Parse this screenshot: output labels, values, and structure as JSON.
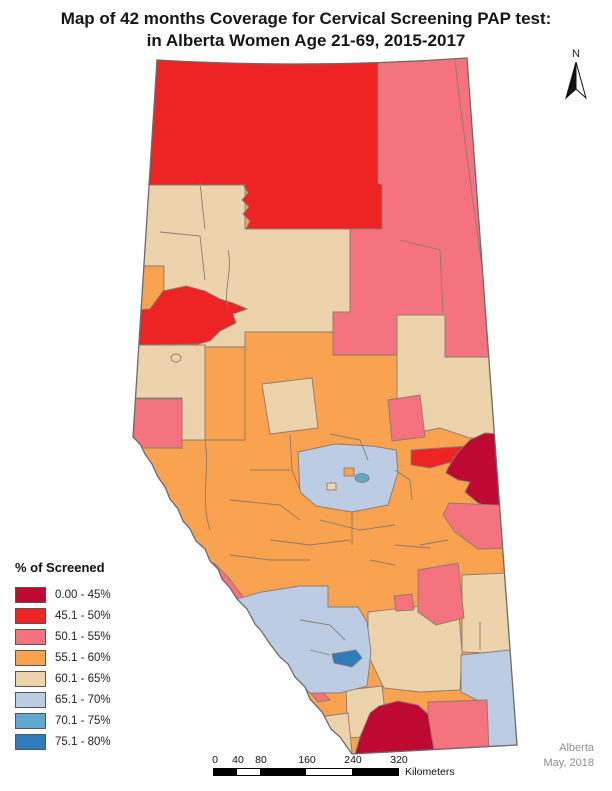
{
  "title": {
    "line1": "Map of 42 months Coverage for Cervical Screening PAP test:",
    "line2": "in Alberta Women Age 21-69, 2015-2017"
  },
  "north_label": "N",
  "legend": {
    "title": "% of Screened",
    "items": [
      {
        "label": "0.00 - 45%",
        "color": "#be0a33"
      },
      {
        "label": "45.1 - 50%",
        "color": "#ee2424"
      },
      {
        "label": "50.1 - 55%",
        "color": "#f4737e"
      },
      {
        "label": "55.1 - 60%",
        "color": "#f9a24f"
      },
      {
        "label": "60.1 - 65%",
        "color": "#edd3ac"
      },
      {
        "label": "65.1 - 70%",
        "color": "#bccce2"
      },
      {
        "label": "70.1 - 75%",
        "color": "#5fa8d2"
      },
      {
        "label": "75.1 - 80%",
        "color": "#2e7cbb"
      }
    ]
  },
  "colors": {
    "class1": "#be0a33",
    "class2": "#ee2424",
    "class3": "#f4737e",
    "class4": "#f9a24f",
    "class5": "#edd3ac",
    "class6": "#bccce2",
    "class7": "#5fa8d2",
    "class8": "#2e7cbb",
    "outline": "#6a6a6a",
    "boundary": "#8a7c6e"
  },
  "scalebar": {
    "ticks": [
      "0",
      "40",
      "80",
      "160",
      "240",
      "320"
    ],
    "unit": "Kilometers"
  },
  "credits": {
    "region": "Alberta",
    "date": "May, 2018"
  }
}
